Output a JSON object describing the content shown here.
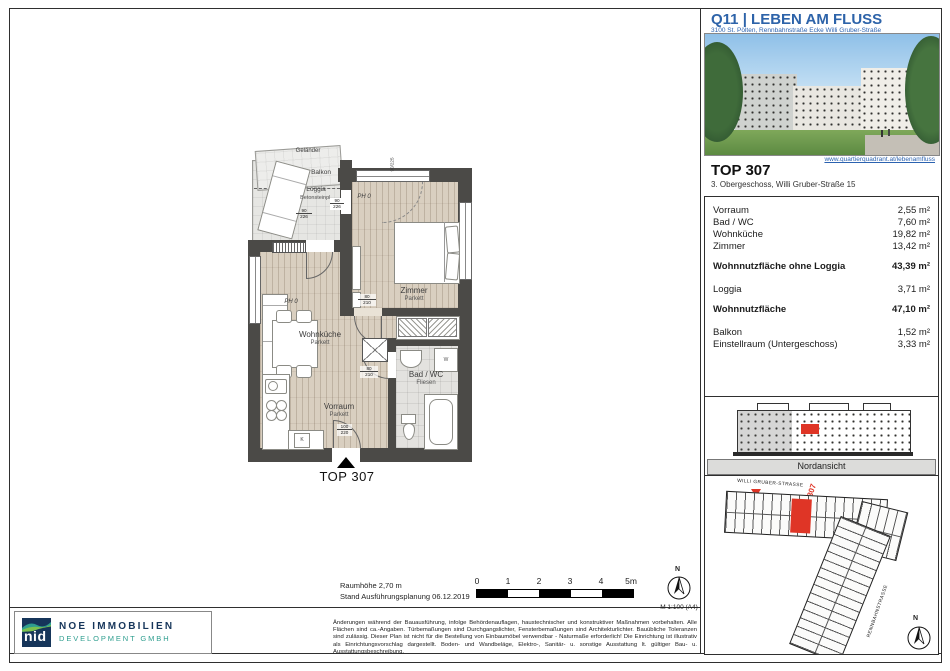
{
  "colors": {
    "highlight_red": "#df3526",
    "brand_blue": "#2d63a9",
    "logo_navy": "#16355a",
    "logo_teal": "#2f9e8f",
    "wall_gray": "#4b4a47"
  },
  "header": {
    "title": "Q11 | LEBEN AM FLUSS",
    "address": "3100 St. Pölten, Rennbahnstraße Ecke Willi Gruber-Straße",
    "website": "www.quartierquadrant.at/lebenamfluss"
  },
  "unit": {
    "name": "TOP 307",
    "floor_info": "3. Obergeschoss, Willi Gruber-Straße 15"
  },
  "areas": {
    "rows": [
      {
        "label": "Vorraum",
        "value": "2,55 m²"
      },
      {
        "label": "Bad / WC",
        "value": "7,60 m²"
      },
      {
        "label": "Wohnküche",
        "value": "19,82 m²"
      },
      {
        "label": "Zimmer",
        "value": "13,42 m²"
      },
      {
        "label": "Wohnnutzfläche ohne Loggia",
        "value": "43,39 m²"
      },
      {
        "label": "Loggia",
        "value": "3,71 m²"
      },
      {
        "label": "Wohnnutzfläche",
        "value": "47,10 m²"
      },
      {
        "label": "Balkon",
        "value": "1,52 m²"
      },
      {
        "label": "Einstellraum (Untergeschoss)",
        "value": "3,33 m²"
      }
    ]
  },
  "elevation": {
    "caption": "Nordansicht"
  },
  "site_plan": {
    "street_top": "WILLI GRUBER-STRASSE",
    "street_side": "RENNBAHNSTRASSE",
    "unit_number": "307",
    "north": "N"
  },
  "floor_plan": {
    "marker": "TOP 307",
    "rooms": {
      "zimmer": {
        "name": "Zimmer",
        "floor": "Parkett"
      },
      "wohnkueche": {
        "name": "Wohnküche",
        "floor": "Parkett"
      },
      "bad": {
        "name": "Bad / WC",
        "floor": "Fliesen"
      },
      "vorraum": {
        "name": "Vorraum",
        "floor": "Parkett"
      },
      "loggia": {
        "name": "Loggia",
        "floor": "Betonsteinpl."
      },
      "balkon": {
        "name": "Balkon"
      }
    },
    "labels": {
      "gelaender": "Geländer",
      "ph": "PH 0",
      "washer": "W",
      "kitchen": "K"
    },
    "dims": {
      "loggia_door": [
        "90",
        "226"
      ],
      "zimmer_window": [
        "90",
        "226"
      ],
      "zimmer_door": [
        "80",
        "210"
      ],
      "bad_door": [
        "80",
        "210"
      ],
      "entry_door": [
        "100",
        "220"
      ],
      "top_window": "90/225"
    }
  },
  "footer": {
    "room_height": "Raumhöhe 2,70 m",
    "status": "Stand Ausführungsplanung 06.12.2019",
    "scale_ticks": [
      "0",
      "1",
      "2",
      "3",
      "4",
      "5m"
    ],
    "scale_note": "M 1:100 (A4)",
    "north": "N",
    "disclaimer": "Änderungen während der Bauausführung, infolge Behördenauflagen, haustechnischer und konstruktiver Maßnahmen vorbehalten. Alle Flächen sind ca.-Angaben. Türbemaßungen sind Durchgangslichter, Fensterbemaßungen sind Architekturlichter. Bauübliche Toleranzen sind zulässig. Dieser Plan ist nicht für die Bestellung von Einbaumöbel verwendbar - Naturmaße erforderlich! Die Einrichtung ist illustrativ als Einrichtungsvorschlag dargestellt. Boden- und Wandbeläge, Elektro-, Sanitär- u. sonstige Ausstattung lt. gültiger Bau- u. Ausstattungsbeschreibung."
  },
  "logo": {
    "mark": "nid",
    "company": "NOE IMMOBILIEN",
    "subtitle": "DEVELOPMENT GMBH"
  }
}
